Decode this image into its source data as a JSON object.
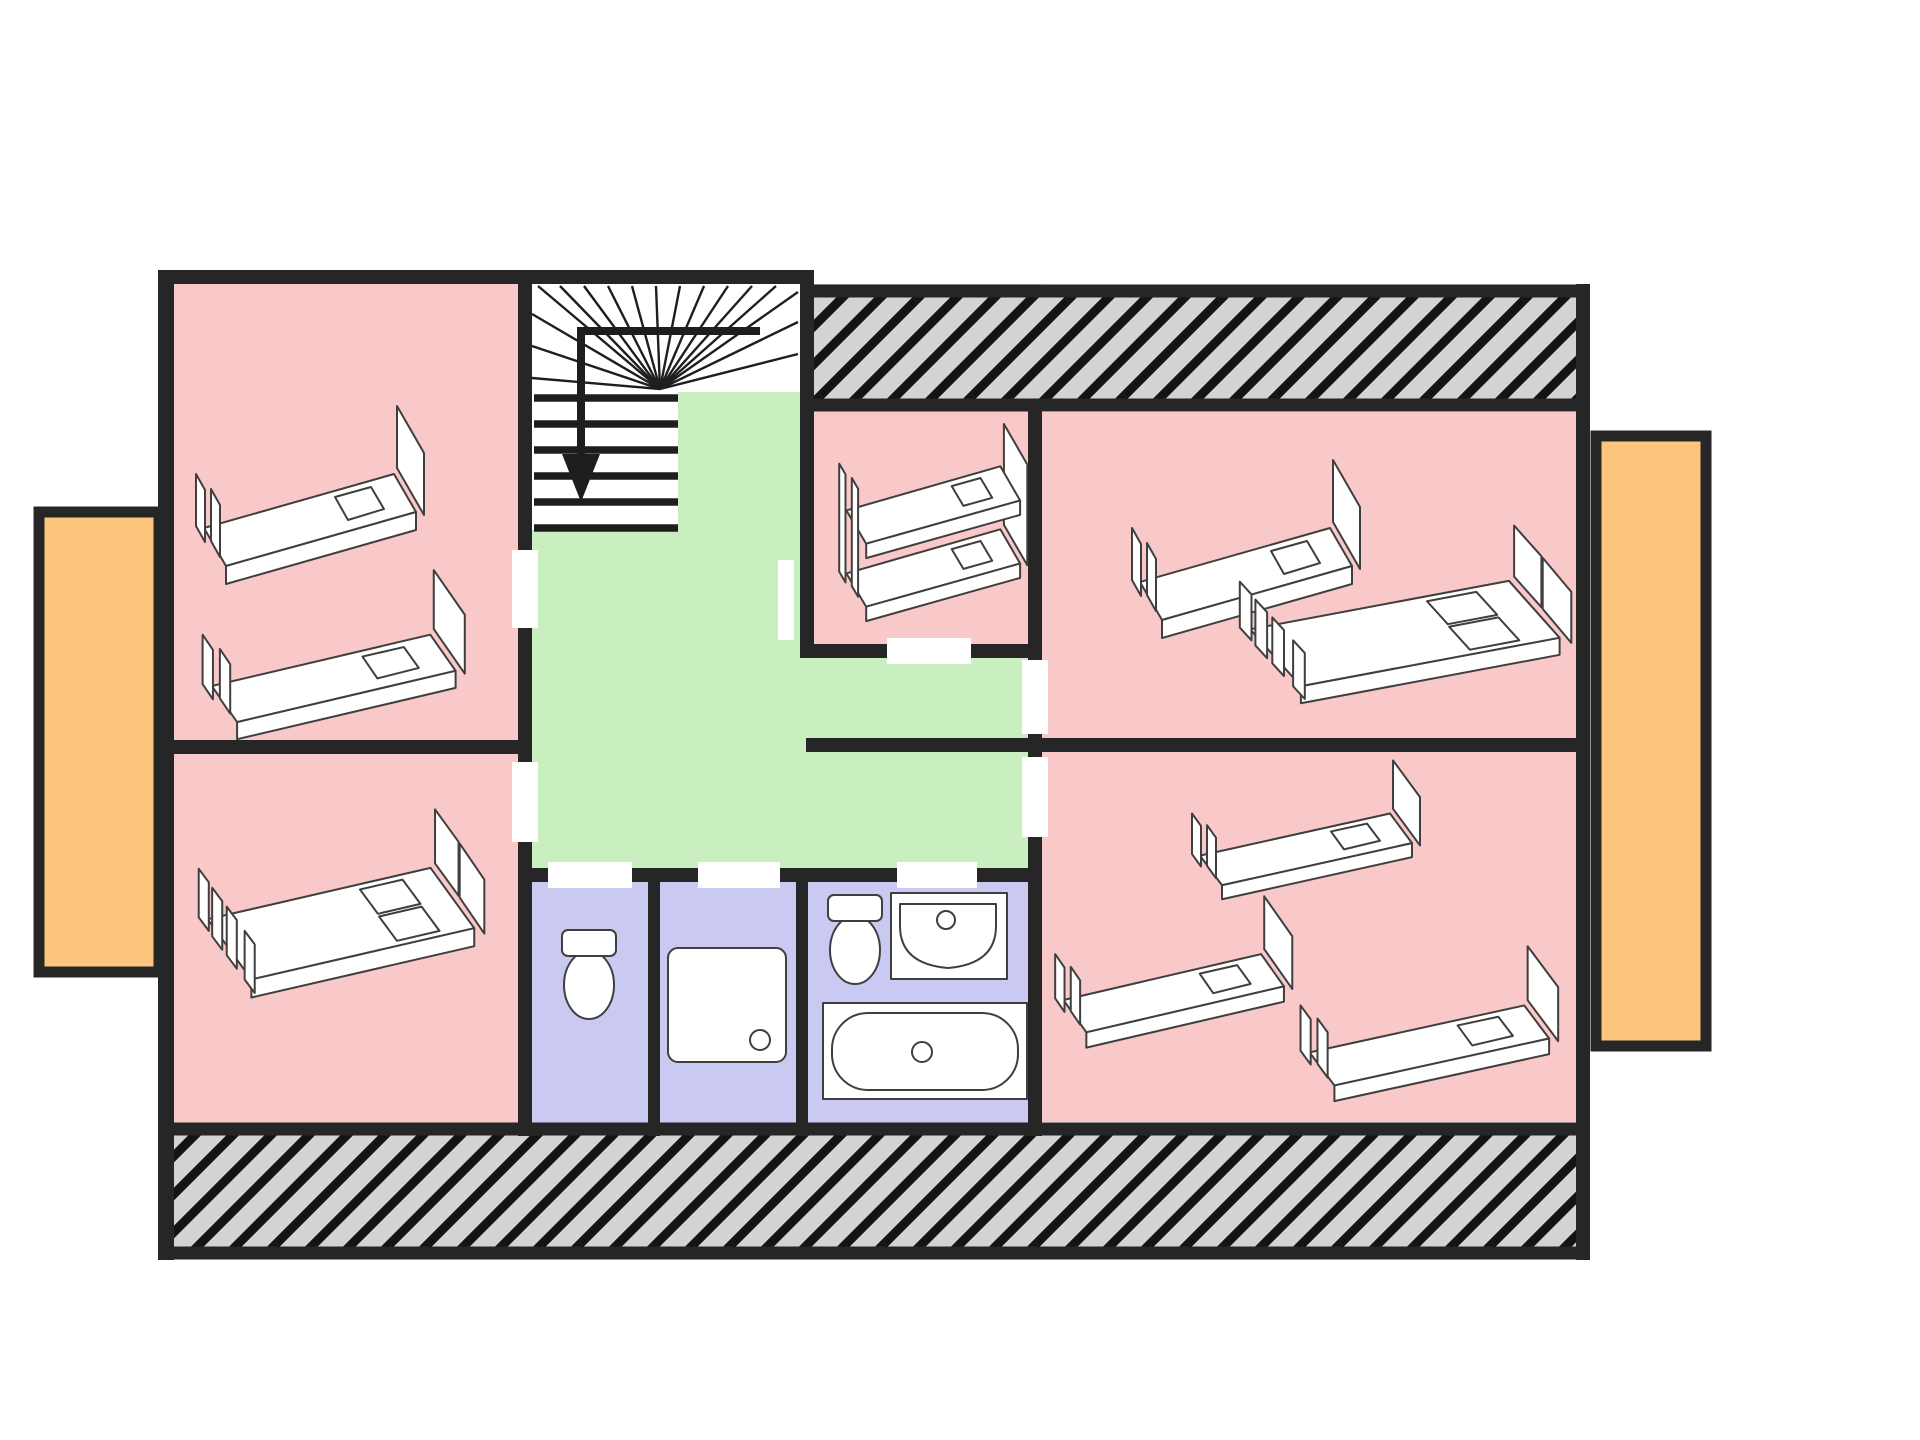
{
  "plan": {
    "canvas": {
      "width": 1920,
      "height": 1440,
      "background": "#ffffff"
    },
    "palette": {
      "bedroom_pink": "#f9c8c8",
      "hall_green": "#c9efc1",
      "bath_lavender": "#c9c9f1",
      "balcony_orange": "#fbc57e",
      "wall_black": "#262626",
      "hatch_gray": "#d3d3d3",
      "hatch_line": "#141414",
      "stair_white": "#ffffff",
      "fixture_white": "#ffffff",
      "fixture_stroke": "#3f3f3f"
    },
    "rooms": [
      {
        "id": "landing-hall",
        "fill": "hall_green",
        "rect": [
          532,
          284,
          510,
          598
        ]
      },
      {
        "id": "bunk-bedroom",
        "fill": "bedroom_pink",
        "rect": [
          800,
          398,
          242,
          260
        ]
      },
      {
        "id": "bedroom-top-left",
        "fill": "bedroom_pink",
        "rect": [
          174,
          284,
          358,
          470
        ]
      },
      {
        "id": "bedroom-bottom-left",
        "fill": "bedroom_pink",
        "rect": [
          174,
          740,
          358,
          396
        ]
      },
      {
        "id": "bedroom-top-right",
        "fill": "bedroom_pink",
        "rect": [
          1042,
          412,
          536,
          342
        ]
      },
      {
        "id": "bedroom-bottom-right",
        "fill": "bedroom_pink",
        "rect": [
          1042,
          740,
          536,
          382
        ]
      },
      {
        "id": "wc-room",
        "fill": "bath_lavender",
        "rect": [
          532,
          868,
          128,
          268
        ]
      },
      {
        "id": "shower-room",
        "fill": "bath_lavender",
        "rect": [
          648,
          868,
          160,
          268
        ]
      },
      {
        "id": "bathroom",
        "fill": "bath_lavender",
        "rect": [
          796,
          868,
          246,
          268
        ]
      }
    ],
    "stair_area": {
      "white_boxes": [
        [
          532,
          284,
          268,
          108
        ],
        [
          532,
          392,
          146,
          138
        ]
      ],
      "fan": {
        "cx": 660,
        "cy": 389,
        "ends": [
          [
            532,
            378
          ],
          [
            532,
            346
          ],
          [
            532,
            314
          ],
          [
            538,
            286
          ],
          [
            560,
            286
          ],
          [
            584,
            286
          ],
          [
            608,
            286
          ],
          [
            632,
            286
          ],
          [
            656,
            286
          ],
          [
            680,
            286
          ],
          [
            704,
            286
          ],
          [
            728,
            286
          ],
          [
            752,
            286
          ],
          [
            776,
            286
          ],
          [
            798,
            292
          ],
          [
            798,
            322
          ],
          [
            798,
            354
          ]
        ]
      },
      "treads": {
        "x1": 534,
        "x2": 678,
        "ys": [
          398,
          424,
          450,
          476,
          502,
          528
        ]
      },
      "arrow": {
        "line": "760,331 581,331 581,458",
        "head": "562,454 600,454 581,502"
      }
    },
    "hatch_strips": [
      {
        "id": "roof-strip-top",
        "rect": [
          807,
          291,
          776,
          114
        ]
      },
      {
        "id": "roof-strip-bottom",
        "rect": [
          165,
          1129,
          1418,
          124
        ]
      }
    ],
    "balconies": [
      {
        "id": "balcony-left",
        "rect": [
          39,
          512,
          120,
          460
        ]
      },
      {
        "id": "balcony-right",
        "rect": [
          1596,
          436,
          110,
          610
        ]
      }
    ],
    "walls": [
      [
        158,
        270,
        656,
        14
      ],
      [
        158,
        270,
        16,
        990
      ],
      [
        1576,
        284,
        14,
        976
      ],
      [
        518,
        284,
        14,
        852
      ],
      [
        158,
        740,
        374,
        14
      ],
      [
        800,
        284,
        14,
        374
      ],
      [
        800,
        644,
        242,
        14
      ],
      [
        1028,
        405,
        14,
        731
      ],
      [
        806,
        738,
        784,
        14
      ],
      [
        518,
        868,
        524,
        14
      ],
      [
        648,
        868,
        12,
        268
      ],
      [
        796,
        868,
        12,
        268
      ]
    ],
    "door_openings": [
      [
        512,
        550,
        26,
        78
      ],
      [
        512,
        762,
        26,
        80
      ],
      [
        887,
        638,
        84,
        26
      ],
      [
        1022,
        660,
        26,
        74
      ],
      [
        1022,
        757,
        26,
        80
      ],
      [
        548,
        862,
        84,
        26
      ],
      [
        698,
        862,
        82,
        26
      ],
      [
        897,
        862,
        80,
        26
      ]
    ],
    "white_patches": [
      [
        778,
        560,
        16,
        80
      ]
    ],
    "furniture": [
      {
        "type": "single-bed",
        "x": 192,
        "y": 408,
        "sx": 1,
        "sy": 1
      },
      {
        "type": "single-bed",
        "x": 198,
        "y": 572,
        "sx": 1.15,
        "sy": 0.95
      },
      {
        "type": "bunk-bed",
        "x": 832,
        "y": 424,
        "sx": 0.9,
        "sy": 0.9
      },
      {
        "type": "single-bed",
        "x": 1128,
        "y": 462,
        "sx": 1,
        "sy": 1
      },
      {
        "type": "double-bed",
        "x": 1232,
        "y": 512,
        "sx": 1.3,
        "sy": 0.85
      },
      {
        "type": "double-bed",
        "x": 192,
        "y": 795,
        "sx": 1.12,
        "sy": 0.9
      },
      {
        "type": "single-bed",
        "x": 1188,
        "y": 762,
        "sx": 1,
        "sy": 0.78
      },
      {
        "type": "single-bed",
        "x": 1051,
        "y": 898,
        "sx": 1.04,
        "sy": 0.85
      },
      {
        "type": "single-bed",
        "x": 1296,
        "y": 948,
        "sx": 1.13,
        "sy": 0.87
      },
      {
        "type": "toilet",
        "x": 560,
        "y": 928,
        "sx": 1,
        "sy": 1
      },
      {
        "type": "shower",
        "x": 666,
        "y": 946,
        "sx": 1,
        "sy": 1
      },
      {
        "type": "toilet",
        "x": 826,
        "y": 893,
        "sx": 1,
        "sy": 1
      },
      {
        "type": "washbasin",
        "x": 890,
        "y": 892,
        "sx": 1,
        "sy": 1
      },
      {
        "type": "bathtub",
        "x": 822,
        "y": 1002,
        "sx": 1,
        "sy": 1
      }
    ]
  }
}
